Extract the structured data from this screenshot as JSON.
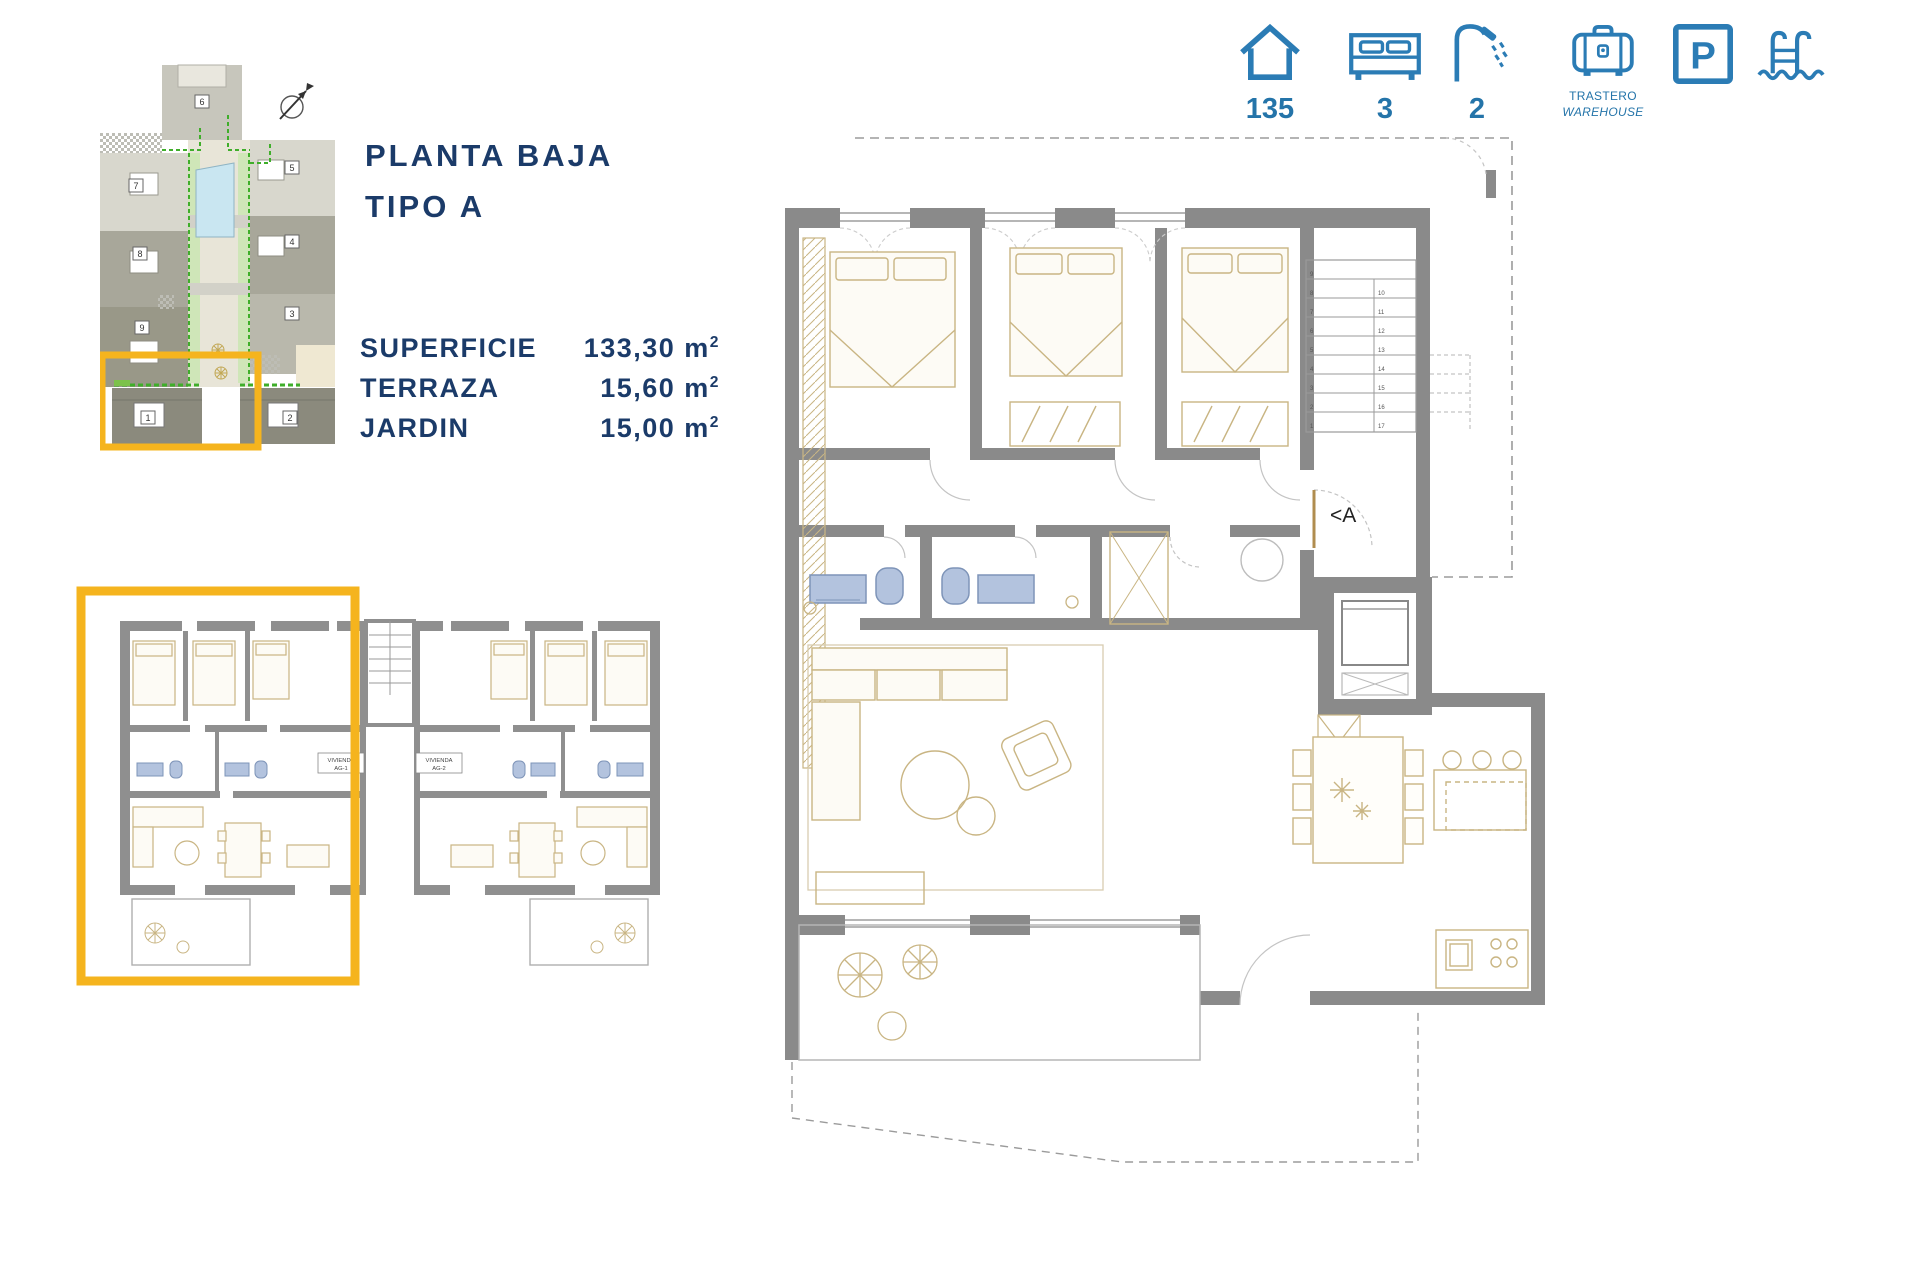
{
  "colors": {
    "navy": "#1b3b69",
    "icon_blue": "#2b7cb5",
    "highlight_yellow": "#f5b41e",
    "wall_gray": "#8a8a8a",
    "furniture_tan": "#c9b583",
    "fixture_blue": "#b3c3de",
    "pool_blue": "#c9e6f1"
  },
  "header": {
    "title_line1": "PLANTA BAJA",
    "title_line2": "TIPO A"
  },
  "specs": {
    "rows": [
      {
        "label": "SUPERFICIE",
        "value": "133,30 m",
        "sup": "2"
      },
      {
        "label": "TERRAZA",
        "value": "15,60 m",
        "sup": "2"
      },
      {
        "label": "JARDIN",
        "value": "15,00 m",
        "sup": "2"
      }
    ]
  },
  "amenity_bar": {
    "house_value": "135",
    "bed_value": "3",
    "shower_value": "2",
    "warehouse_label_line1": "TRASTERO",
    "warehouse_label_line2": "WAREHOUSE",
    "parking_letter": "P"
  },
  "site_plan": {
    "block_numbers": {
      "b1": "1",
      "b2": "2",
      "b3": "3",
      "b4": "4",
      "b5": "5",
      "b6": "6",
      "b7": "7",
      "b8": "8",
      "b9": "9"
    }
  },
  "ground_floor_plan": {
    "unit1_label_line1": "VIVIENDA",
    "unit1_label_line2": "AG-1",
    "unit2_label_line1": "VIVIENDA",
    "unit2_label_line2": "AG-2"
  },
  "main_plan": {
    "entrance_label": "<A",
    "stair_numbers_left": [
      "9",
      "8",
      "7",
      "6",
      "5",
      "4",
      "3",
      "2",
      "1"
    ],
    "stair_numbers_right": [
      "10",
      "11",
      "12",
      "13",
      "14",
      "15",
      "16",
      "17"
    ]
  }
}
